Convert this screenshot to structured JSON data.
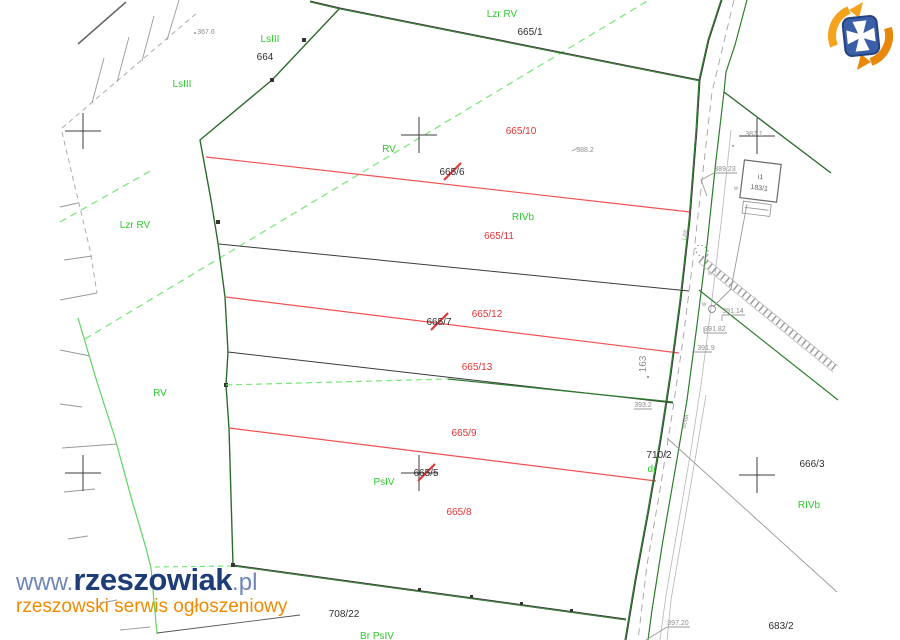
{
  "branding": {
    "site_url_prefix": "www.",
    "site_name": "rzeszowiak",
    "site_tld": ".pl",
    "tagline": "rzeszowski serwis ogłoszeniowy"
  },
  "logo": {
    "name": "rzeszowiak-logo",
    "shield_color": "#3b5ea9",
    "cross_color": "#ffffff",
    "swirl_color": "#f59d1e"
  },
  "colors": {
    "parcel_boundary_green": "#2e6b2e",
    "land_use_green": "#76e876",
    "subdivision_red": "#f05252",
    "label_red": "#e03434",
    "label_green": "#2fca2f",
    "survey_gray": "#8d8d8d",
    "line_black": "#3a3a3a"
  },
  "map": {
    "labels_black": [
      {
        "text": "664"
      },
      {
        "text": "665/1"
      },
      {
        "text": "710/2"
      },
      {
        "text": "666/3"
      },
      {
        "text": "683/2"
      },
      {
        "text": "708/22"
      }
    ],
    "labels_red": [
      {
        "text": "665/10"
      },
      {
        "text": "665/11"
      },
      {
        "text": "665/12"
      },
      {
        "text": "665/13"
      },
      {
        "text": "665/9"
      },
      {
        "text": "665/8"
      }
    ],
    "labels_crossed": [
      {
        "text": "665/6"
      },
      {
        "text": "665/7"
      },
      {
        "text": "665/5"
      }
    ],
    "labels_green": [
      {
        "text": "Lzr RV"
      },
      {
        "text": "LsIII"
      },
      {
        "text": "LsIII"
      },
      {
        "text": "Lzr RV"
      },
      {
        "text": "RV"
      },
      {
        "text": "RIVb"
      },
      {
        "text": "RV"
      },
      {
        "text": "PsIV"
      },
      {
        "text": "dr"
      },
      {
        "text": "RIVb"
      },
      {
        "text": "Br PsIV"
      }
    ],
    "labels_gray": [
      {
        "text": "367.6"
      },
      {
        "text": "388.2"
      },
      {
        "text": "387.1"
      },
      {
        "text": "389.23"
      },
      {
        "text": "391.14"
      },
      {
        "text": "391.82"
      },
      {
        "text": "391.9"
      },
      {
        "text": "393.2"
      },
      {
        "text": "397.20"
      },
      {
        "text": "163"
      },
      {
        "text": "woda"
      },
      {
        "text": "j.zw"
      }
    ],
    "markers_w": [
      {
        "text": "w"
      },
      {
        "text": "w"
      },
      {
        "text": "w"
      }
    ],
    "building": {
      "line1": "i1",
      "line2": "183/1"
    }
  }
}
